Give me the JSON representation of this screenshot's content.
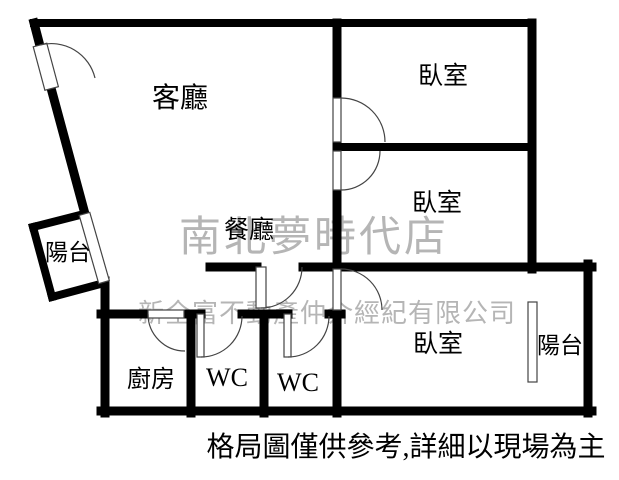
{
  "plan": {
    "rooms": {
      "living": "客廳",
      "bedroom_top": "臥室",
      "bedroom_mid": "臥室",
      "bedroom_bottom": "臥室",
      "dining": "餐廳",
      "balcony_left": "陽台",
      "balcony_right": "陽台",
      "kitchen": "廚房",
      "wc1": "WC",
      "wc2": "WC"
    },
    "watermark": {
      "store": "南北夢時代店",
      "company": "新全富不動產仲介經紀有限公司"
    },
    "disclaimer": "格局圖僅供參考,詳細以現場為主",
    "colors": {
      "wall": "#000000",
      "thin_line": "#444444",
      "watermark": "#b5b5b5",
      "background": "#ffffff",
      "text": "#000000"
    }
  }
}
